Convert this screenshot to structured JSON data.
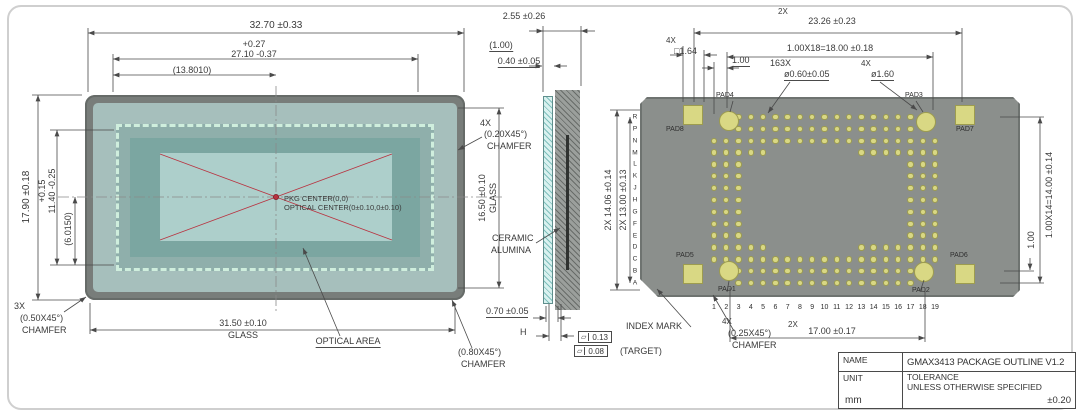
{
  "left_view": {
    "dims": {
      "width_total": "32.70 ±0.33",
      "width_inner_plus": "+0.27",
      "width_inner": "27.10 -0.37",
      "half_ref": "(13.8010)",
      "height_total": "17.90 ±0.18",
      "height_inner_plus": "+0.15",
      "height_inner": "11.40 -0.25",
      "half_v_ref": "(6.0150)",
      "glass_width": "31.50 ±0.10",
      "glass_width_label": "GLASS",
      "glass_height": "16.50 ±0.10",
      "glass_height_label": "GLASS"
    },
    "chamfer_3x": {
      "qty": "3X",
      "size": "(0.50X45°)",
      "label": "CHAMFER"
    },
    "chamfer_4x": {
      "qty": "4X",
      "size": "(0.20X45°)",
      "label": "CHAMFER"
    },
    "chamfer_080": {
      "size": "(0.80X45°)",
      "label": "CHAMFER"
    },
    "optical_area_label": "OPTICAL AREA",
    "pkg_center": "PKG CENTER(0,0)",
    "optical_center": "OPTICAL CENTER(0±0.10,0±0.10)"
  },
  "section_view": {
    "thickness": "2.55 ±0.26",
    "ref": "(1.00)",
    "glass_thickness": "0.40 ±0.05",
    "material_line1": "CERAMIC",
    "material_line2": "ALUMINA",
    "bottom": "0.70 ±0.05",
    "h_label": "H",
    "flatness_symbol": "▱",
    "flatness1": "0.13",
    "flatness2": "0.08",
    "flatness2_note": "(TARGET)"
  },
  "right_view": {
    "dims": {
      "top_qty": "2X",
      "top": "23.26 ±0.23",
      "pitch_row_top": "1.00X18=18.00 ±0.18",
      "sq_qty": "4X",
      "sq": "□1.64",
      "pitch1": "1.00",
      "holes_qty": "163X",
      "holes_dia": "ø0.60±0.05",
      "circ_qty": "4X",
      "circ_dia": "ø1.60",
      "left_outer": "2X 14.06 ±0.14",
      "left_inner": "2X 13.00 ±0.13",
      "right_pitch_total": "1.00X14=14.00 ±0.14",
      "right_pitch": "1.00",
      "bottom_qty": "2X",
      "bottom": "17.00 ±0.17"
    },
    "index_mark": "INDEX MARK",
    "chamfer_4x": {
      "qty": "4X",
      "size": "(0.25X45°)",
      "label": "CHAMFER"
    },
    "pad_labels": {
      "pad1": "PAD1",
      "pad2": "PAD2",
      "pad3": "PAD3",
      "pad4": "PAD4",
      "pad5": "PAD5",
      "pad6": "PAD6",
      "pad7": "PAD7",
      "pad8": "PAD8"
    },
    "row_letters": [
      "R",
      "P",
      "N",
      "M",
      "L",
      "K",
      "J",
      "H",
      "G",
      "F",
      "E",
      "D",
      "C",
      "B",
      "A"
    ],
    "col_numbers": [
      "1",
      "2",
      "3",
      "4",
      "5",
      "6",
      "7",
      "8",
      "9",
      "10",
      "11",
      "12",
      "13",
      "14",
      "15",
      "16",
      "17",
      "18",
      "19"
    ],
    "hole_pattern": [
      {
        "row": 0,
        "ranges": [
          [
            2,
            16
          ]
        ]
      },
      {
        "row": 1,
        "ranges": [
          [
            2,
            16
          ]
        ]
      },
      {
        "row": 2,
        "ranges": [
          [
            0,
            18
          ]
        ]
      },
      {
        "row": 3,
        "ranges": [
          [
            0,
            4
          ],
          [
            12,
            18
          ]
        ]
      },
      {
        "row": 4,
        "ranges": [
          [
            0,
            2
          ],
          [
            16,
            18
          ]
        ]
      },
      {
        "row": 5,
        "ranges": [
          [
            0,
            2
          ],
          [
            16,
            18
          ]
        ]
      },
      {
        "row": 6,
        "ranges": [
          [
            0,
            2
          ],
          [
            16,
            18
          ]
        ]
      },
      {
        "row": 7,
        "ranges": [
          [
            0,
            2
          ],
          [
            16,
            18
          ]
        ]
      },
      {
        "row": 8,
        "ranges": [
          [
            0,
            2
          ],
          [
            16,
            18
          ]
        ]
      },
      {
        "row": 9,
        "ranges": [
          [
            0,
            2
          ],
          [
            16,
            18
          ]
        ]
      },
      {
        "row": 10,
        "ranges": [
          [
            0,
            2
          ],
          [
            16,
            18
          ]
        ]
      },
      {
        "row": 11,
        "ranges": [
          [
            0,
            4
          ],
          [
            12,
            18
          ]
        ]
      },
      {
        "row": 12,
        "ranges": [
          [
            0,
            18
          ]
        ]
      },
      {
        "row": 13,
        "ranges": [
          [
            2,
            16
          ]
        ]
      },
      {
        "row": 14,
        "ranges": [
          [
            2,
            16
          ]
        ]
      }
    ]
  },
  "title_block": {
    "name_label": "NAME",
    "name_value": "GMAX3413 PACKAGE OUTLINE V1.2",
    "unit_label": "UNIT",
    "unit_value": "mm",
    "tol_line1": "TOLERANCE",
    "tol_line2": "UNLESS OTHERWISE SPECIFIED",
    "tol_value": "±0.20"
  },
  "colors": {
    "body_gray": "#8b8f8c",
    "glass_teal": "#a6bfbc",
    "optical_teal": "#adcfcb",
    "pad_yellow": "#d9d884",
    "marker_red": "#b83340",
    "dim_line": "#4a4a4a"
  }
}
